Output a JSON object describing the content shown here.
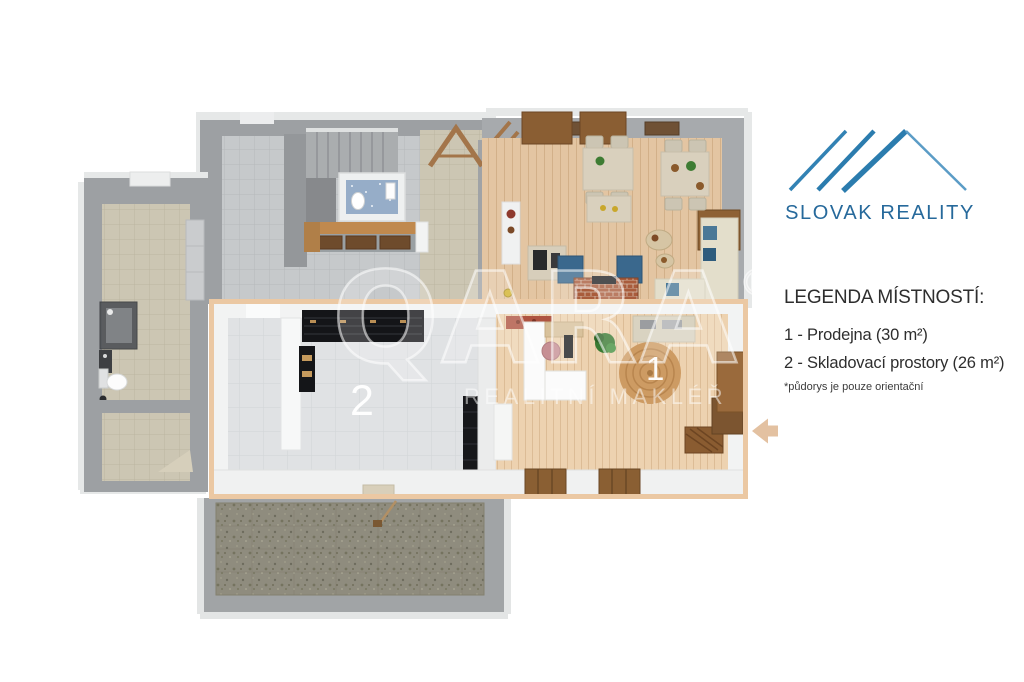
{
  "branding": {
    "logo_text": "SLOVAK REALITY",
    "logo_color": "#26699b",
    "logo_icon": "roof-icon"
  },
  "legend": {
    "heading": "LEGENDA MÍSTNOSTÍ:",
    "items": [
      {
        "label": "1 - Prodejna (30 m²)"
      },
      {
        "label": "2 - Skladovací prostory (26 m²)"
      }
    ],
    "footnote": "*půdorys je pouze orientační"
  },
  "floorplan": {
    "room1_label": "1",
    "room2_label": "2",
    "highlight_color": "#ebc8a3",
    "arrow_color": "#e3c1a1",
    "arrow_icon": "arrow-left-icon"
  },
  "watermark": {
    "brand": "QARA",
    "registered": "®",
    "subtitle": "REALITNÍ MAKLÉŘ"
  }
}
